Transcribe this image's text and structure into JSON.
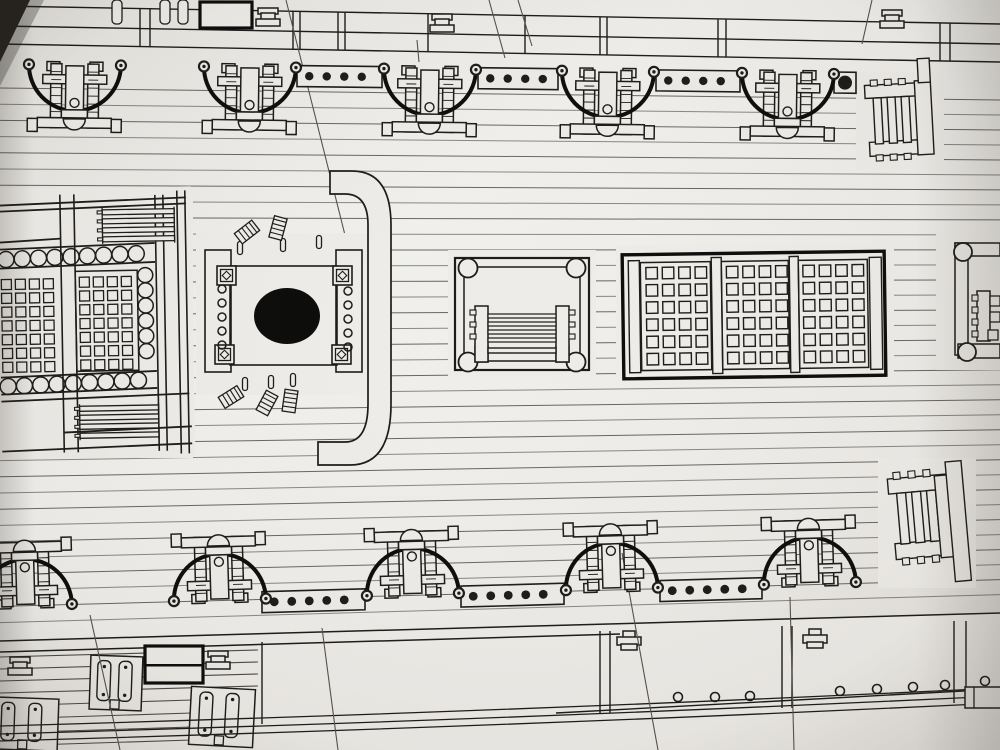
{
  "meta": {
    "description": "Photographed page of a wooden warship model deck plan: two rows of five gun carriages with breeching rope arcs, dotted pin rails, a main hatch with gratings, mast partners with round mast hole, curved rail, companionway ladders and a triple grating.",
    "figure_type": "ship deck plan blueprint photo"
  },
  "palette": {
    "paper": "#eeece8",
    "paper_edge": "#dcd9d4",
    "ink": "#1b1a18",
    "bold": "#0c0b0a",
    "plank_line": "#4a4744",
    "stray_line": "#55514c",
    "corner_dark": "#26231f",
    "mast_hole": "#0a0a09"
  },
  "canvas": {
    "width": 1000,
    "height": 750
  },
  "planking": {
    "y_start": 88,
    "count": 34,
    "spacing": 16.2,
    "slope_top": 0.012,
    "slope_bottom": -0.028
  },
  "patches": [
    [
      0,
      188,
      193,
      270
    ],
    [
      196,
      233,
      182,
      162
    ],
    [
      448,
      250,
      148,
      130
    ],
    [
      616,
      245,
      278,
      140
    ],
    [
      856,
      72,
      88,
      98
    ],
    [
      936,
      234,
      64,
      136
    ],
    [
      878,
      458,
      98,
      130
    ]
  ],
  "stray_lines": [
    [
      286,
      0,
      348,
      247
    ],
    [
      489,
      0,
      505,
      58
    ],
    [
      417,
      40,
      419,
      62
    ],
    [
      518,
      0,
      532,
      46
    ],
    [
      872,
      0,
      862,
      44
    ],
    [
      622,
      553,
      658,
      750
    ],
    [
      90,
      615,
      120,
      750
    ],
    [
      790,
      597,
      794,
      750
    ],
    [
      322,
      628,
      338,
      750
    ]
  ],
  "top_band": {
    "lines": [
      [
        0,
        6,
        1000,
        24
      ],
      [
        0,
        26,
        1000,
        44
      ],
      [
        0,
        44,
        1000,
        62
      ]
    ],
    "divider_xs": [
      140,
      150,
      293,
      300,
      338,
      345,
      428,
      525,
      600,
      607,
      718,
      726,
      940,
      950
    ],
    "bold_rect": [
      200,
      2,
      52,
      26
    ],
    "fittings": [
      [
        256,
        8
      ],
      [
        430,
        14
      ],
      [
        880,
        10
      ]
    ],
    "straps": [
      [
        112,
        0
      ],
      [
        160,
        0
      ],
      [
        178,
        0
      ]
    ],
    "strap_size": [
      10,
      24
    ]
  },
  "rail_top": {
    "y0": 61,
    "slope": 0.012,
    "segments": [
      [
        297,
        382
      ],
      [
        478,
        558
      ],
      [
        656,
        740
      ],
      [
        834,
        856
      ]
    ],
    "dot_step": 17.5,
    "dot_r": 4.2,
    "end_dot": [
      845,
      7
    ],
    "band": [
      1,
      22
    ],
    "dot_off": 11.5
  },
  "rail_bottom": {
    "y0": 609,
    "slope": -0.028,
    "segments": [
      [
        262,
        365
      ],
      [
        461,
        564
      ],
      [
        660,
        762
      ]
    ],
    "dot_step": 17.5,
    "dot_r": 4.4,
    "end_dot": null,
    "band": [
      -10,
      11
    ],
    "dot_off": 0.5
  },
  "cannons_top": [
    75,
    250,
    430,
    608,
    788
  ],
  "cannons_bottom": [
    26,
    220,
    413,
    612,
    810
  ],
  "cannon": {
    "arc_r": 46,
    "rot_top": 0.7,
    "rot_bottom": -1.6
  },
  "main_hatch": {
    "rot": [
      -1,
      95,
      320
    ],
    "backing": [
      0,
      188,
      193,
      270
    ],
    "vlines": [
      [
        62,
        194,
        62,
        452
      ],
      [
        76,
        194,
        76,
        452
      ],
      [
        157,
        196,
        157,
        452
      ],
      [
        165,
        196,
        165,
        452
      ],
      [
        179,
        192,
        179,
        455
      ],
      [
        187,
        192,
        187,
        455
      ]
    ],
    "hlines": [
      [
        0,
        204,
        188,
        199
      ],
      [
        0,
        210,
        188,
        205
      ],
      [
        0,
        241,
        62,
        238
      ],
      [
        0,
        248,
        156,
        244
      ],
      [
        0,
        267,
        156,
        263
      ],
      [
        0,
        376,
        156,
        372
      ],
      [
        0,
        393,
        156,
        389
      ],
      [
        0,
        400,
        188,
        395
      ],
      [
        0,
        450,
        190,
        445
      ],
      [
        62,
        432,
        190,
        428
      ]
    ],
    "circle_rows": [
      {
        "cy1": 258,
        "cy2": 254,
        "x1": 7,
        "x2": 152,
        "step": 16.3,
        "r": 8
      },
      {
        "cy1": 385,
        "cy2": 381,
        "x1": 7,
        "x2": 138,
        "step": 16.3,
        "r": 8
      }
    ],
    "circle_col": {
      "cx": 146,
      "y1": 276,
      "y2": 366,
      "step": 15.2,
      "r": 7.5
    },
    "panel_border": [
      76,
      271,
      62,
      100
    ],
    "cells": {
      "size": 10,
      "row_step": 13.8,
      "rows": 7,
      "cols_a": [
        2,
        16,
        30,
        44
      ],
      "y_a": 278,
      "cols_b": [
        80,
        94,
        108,
        122
      ],
      "y_b": 277
    },
    "ladders": [
      {
        "x": 104,
        "w": 72,
        "ys": [
          210,
          219,
          228,
          237
        ],
        "h": 5,
        "teeth_x": 99
      },
      {
        "x": 78,
        "w": 79,
        "ys": [
          406,
          415,
          424,
          433
        ],
        "h": 5,
        "teeth_x": 73
      }
    ]
  },
  "mast_partners": {
    "backing": [
      196,
      233,
      182,
      162
    ],
    "planks": [
      [
        205,
        250,
        26,
        122
      ],
      [
        336,
        250,
        26,
        122
      ]
    ],
    "frame": [
      230,
      266,
      107,
      99
    ],
    "corner_blocks": [
      [
        217,
        266
      ],
      [
        333,
        266
      ],
      [
        215,
        345
      ],
      [
        332,
        345
      ]
    ],
    "block_size": 19,
    "circle_cols": [
      {
        "cx": 222,
        "ys": [
          289,
          303,
          317,
          331,
          345
        ],
        "r": 4
      },
      {
        "cx": 348,
        "ys": [
          291,
          305,
          319,
          333,
          347
        ],
        "r": 4
      }
    ],
    "hole": {
      "cx": 287,
      "cy": 316,
      "rx": 33,
      "ry": 28
    },
    "pins": [
      [
        240,
        248
      ],
      [
        283,
        245
      ],
      [
        319,
        242
      ],
      [
        245,
        384
      ],
      [
        271,
        382
      ],
      [
        293,
        380
      ]
    ],
    "combs": [
      [
        247,
        232,
        -38
      ],
      [
        278,
        228,
        -75
      ],
      [
        231,
        397,
        -32
      ],
      [
        267,
        403,
        -62
      ],
      [
        290,
        401,
        -82
      ]
    ]
  },
  "curved_rail": {
    "d": "M 330,171 L 352,171 Q 391,171 391,225 L 391,404 Q 391,465 350,465 L 318,465 L 318,442 L 345,442 Q 368,442 368,404 L 368,225 Q 368,194 345,194 L 330,194 Z"
  },
  "companionway": {
    "backing": [
      448,
      250,
      148,
      130
    ],
    "outer": [
      455,
      258,
      134,
      112
    ],
    "inner": [
      464,
      267,
      116,
      94
    ],
    "corners": [
      [
        468,
        268
      ],
      [
        576,
        268
      ],
      [
        468,
        362
      ],
      [
        576,
        362
      ]
    ],
    "corner_r": 9.5,
    "rails": [
      [
        475,
        306,
        13,
        56
      ],
      [
        556,
        306,
        13,
        56
      ]
    ],
    "rail_teeth": [
      [
        470,
        310,
        6,
        5
      ],
      [
        470,
        322,
        6,
        5
      ],
      [
        470,
        334,
        6,
        5
      ],
      [
        569,
        310,
        6,
        5
      ],
      [
        569,
        322,
        6,
        5
      ],
      [
        569,
        334,
        6,
        5
      ]
    ],
    "rungs": [
      [
        488,
        314,
        68,
        4
      ],
      [
        488,
        322,
        68,
        4
      ],
      [
        488,
        330,
        68,
        4
      ],
      [
        488,
        338,
        68,
        4
      ]
    ],
    "step": [
      488,
      348,
      68,
      5
    ],
    "feet": [
      [
        475,
        346,
        13,
        16
      ],
      [
        556,
        346,
        13,
        16
      ]
    ]
  },
  "triple_grating": {
    "rot": [
      -0.8,
      754,
      315
    ],
    "outer": [
      623,
      253,
      262,
      124
    ],
    "strips": [
      [
        629,
        259,
        11,
        112
      ],
      [
        870,
        259,
        12,
        112
      ]
    ],
    "dividers": [
      [
        712,
        257,
        10,
        116
      ],
      [
        790,
        257,
        9,
        116
      ]
    ],
    "panels": [
      [
        641,
        261,
        70,
        108
      ],
      [
        722,
        261,
        67,
        108
      ],
      [
        799,
        261,
        69,
        108
      ]
    ],
    "cells": {
      "size": 11.5,
      "cols": 4,
      "rows": 6,
      "col_step": 16.4,
      "row_step": 17.2,
      "starts": [
        [
          646.5,
          266
        ],
        [
          727,
          266
        ],
        [
          803.5,
          266
        ]
      ]
    }
  },
  "ladder_top_right": {
    "rot": [
      -3,
      895,
      115
    ],
    "rects": [
      [
        866,
        84,
        60,
        13
      ],
      [
        868,
        141,
        62,
        14
      ],
      [
        874,
        97,
        8,
        46
      ],
      [
        888,
        97,
        8,
        46
      ],
      [
        902,
        97,
        8,
        46
      ],
      [
        916,
        82,
        16,
        74
      ],
      [
        920,
        60,
        12,
        24
      ]
    ],
    "teeth": [
      [
        872,
        79,
        7,
        6
      ],
      [
        886,
        79,
        7,
        6
      ],
      [
        900,
        79,
        7,
        6
      ],
      [
        874,
        154,
        7,
        6
      ],
      [
        888,
        154,
        7,
        6
      ],
      [
        902,
        154,
        7,
        6
      ]
    ]
  },
  "ladder_bottom_right": {
    "rot": [
      -5,
      925,
      520
    ],
    "rects": [
      [
        891,
        476,
        62,
        15
      ],
      [
        893,
        541,
        64,
        16
      ],
      [
        899,
        491,
        9,
        51
      ],
      [
        914,
        491,
        9,
        51
      ],
      [
        929,
        491,
        9,
        51
      ],
      [
        938,
        477,
        16,
        82
      ],
      [
        950,
        464,
        16,
        120
      ]
    ],
    "teeth": [
      [
        897,
        470,
        7,
        7
      ],
      [
        912,
        470,
        7,
        7
      ],
      [
        927,
        470,
        7,
        7
      ],
      [
        899,
        556,
        7,
        7
      ],
      [
        914,
        556,
        7,
        7
      ],
      [
        929,
        556,
        7,
        7
      ]
    ]
  },
  "side_companionway": {
    "circles": [
      [
        963,
        252,
        9
      ],
      [
        967,
        352,
        9
      ]
    ],
    "rects": [
      [
        955,
        243,
        45,
        13
      ],
      [
        955,
        243,
        13,
        112
      ],
      [
        958,
        344,
        42,
        14
      ],
      [
        977,
        291,
        13,
        50
      ]
    ],
    "teeth": [
      [
        972,
        295,
        6,
        6
      ],
      [
        972,
        307,
        6,
        6
      ],
      [
        972,
        319,
        6,
        6
      ],
      [
        972,
        331,
        6,
        6
      ]
    ],
    "squares": [
      [
        990,
        296,
        10,
        10
      ],
      [
        990,
        312,
        10,
        10
      ],
      [
        988,
        330,
        10,
        10
      ]
    ]
  },
  "bottom_band": {
    "backing": "0,640 1000,612 1000,750 0,750",
    "top_lines": [
      [
        0,
        641,
        1000,
        613
      ],
      [
        0,
        652,
        620,
        634
      ]
    ],
    "panel_bottom": [
      556,
      713,
      1000,
      689
    ],
    "dividers": [
      [
        262,
        642,
        262,
        724
      ],
      [
        600,
        631,
        600,
        713
      ],
      [
        610,
        631,
        610,
        713
      ],
      [
        782,
        626,
        782,
        708
      ],
      [
        792,
        626,
        792,
        708
      ],
      [
        954,
        621,
        954,
        703
      ],
      [
        966,
        621,
        966,
        703
      ]
    ],
    "left_lines": [
      [
        0,
        657,
        258,
        650
      ],
      [
        0,
        669,
        258,
        662
      ],
      [
        0,
        681,
        258,
        674
      ],
      [
        0,
        693,
        258,
        686
      ],
      [
        0,
        706,
        192,
        700
      ],
      [
        0,
        719,
        192,
        713
      ],
      [
        0,
        733,
        192,
        727
      ],
      [
        0,
        746,
        192,
        740
      ]
    ],
    "circles": [
      [
        678,
        697
      ],
      [
        715,
        697
      ],
      [
        750,
        696
      ],
      [
        840,
        691
      ],
      [
        877,
        689
      ],
      [
        913,
        687
      ],
      [
        945,
        685
      ],
      [
        985,
        681
      ]
    ],
    "circle_r": 4.5,
    "t_fittings": [
      [
        620,
        631
      ],
      [
        806,
        629
      ]
    ],
    "bold_rect": [
      145,
      646,
      58,
      37
    ],
    "stepped": [
      [
        206,
        651
      ],
      [
        8,
        657
      ]
    ],
    "kevels": [
      [
        90,
        656,
        52,
        54,
        2
      ],
      [
        190,
        688,
        64,
        58,
        3
      ],
      [
        -8,
        698,
        66,
        52,
        2
      ]
    ],
    "hull_curves": [
      "M0,726 Q500,712 1000,688",
      "M0,734 Q500,720 1000,696",
      "M0,741 Q500,727 1000,703"
    ],
    "bracket": [
      965,
      687,
      38,
      21
    ]
  }
}
